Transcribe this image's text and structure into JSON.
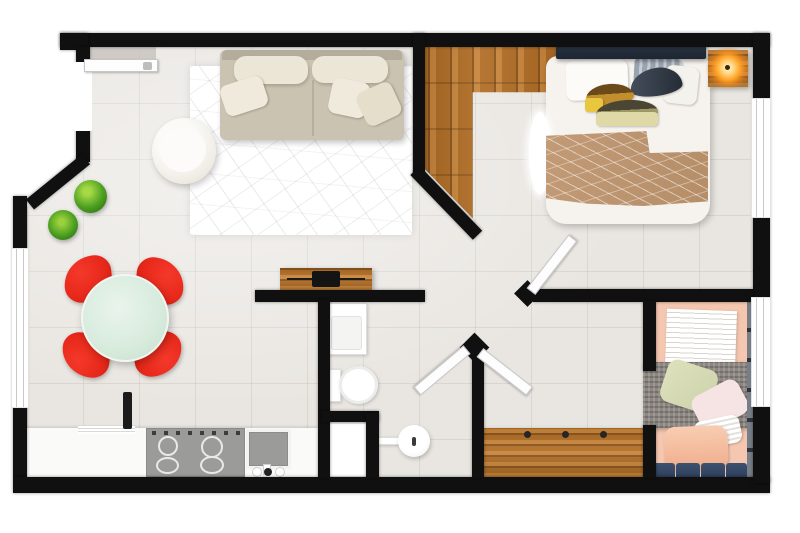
{
  "image": {
    "type": "3d-floor-plan-top-down-render",
    "description": "Top-down 3D render of a one-bedroom-plus-kids-room apartment floor plan with open living/dining/kitchen, master bedroom, second bedroom, bathroom and hallway",
    "width_px": 800,
    "height_px": 533
  },
  "palette": {
    "wall": "#101010",
    "floor_tile": "#e9e6e1",
    "wood": "#b06c24",
    "wood_light": "#c8853a",
    "wood_dark": "#8a541b",
    "rug": "#ffffff",
    "sofa": "#cbc3b1",
    "sofa_cushion": "#ebe6d6",
    "chair_red": "#e6281a",
    "table_mint": "#d7ebdd",
    "plant_green": "#4c9f21",
    "counter": "#fafaf8",
    "appliance_gray": "#9b9b99",
    "fixture_white": "#ffffff",
    "headboard_navy": "#1d2632",
    "blanket_tan": "#b58e68",
    "pillow_mustard": "#c18f2e",
    "pillow_khaki": "#a09a66",
    "pillow_gray": "#9aa4b0",
    "bed2_salmon": "#f5c7b0",
    "pillow_sage": "#ccd2aa",
    "pillow_blush": "#f6e3e4",
    "cushion_navy": "#2c3c58",
    "lamp_glow": "#ffa428",
    "window_frame": "#c9c9c9"
  },
  "rooms": [
    {
      "id": "living-dining-kitchen",
      "label": "open-plan living, dining and kitchen",
      "furniture": [
        "beige sofa with back cushions and three pillows",
        "white round lounge chair",
        "white geometric mesh rug",
        "two green plants",
        "round mint dining table",
        "four red designer chairs",
        "white kitchen counter",
        "four-burner cooktop",
        "square sink with faucet",
        "dish shelf",
        "dark utensil object"
      ]
    },
    {
      "id": "bedroom-1",
      "label": "master bedroom",
      "furniture": [
        "double bed with dark headboard",
        "white bedding with tan knit throw",
        "white fur runner",
        "six assorted pillows",
        "wooden nightstand",
        "glowing table lamp"
      ],
      "floor": "hardwood entry corner over tile",
      "windows": 1,
      "doors": 1
    },
    {
      "id": "bathroom",
      "label": "bathroom",
      "furniture": [
        "rectangular vanity sink",
        "toilet",
        "white shower-washer closet",
        "round pedestal basin with wall arm"
      ],
      "doors": 1
    },
    {
      "id": "hallway",
      "label": "hallway",
      "furniture": [
        "wooden tv sideboard with tv and soundbar on half wall",
        "long wooden bench with three knobs"
      ],
      "doors": 3
    },
    {
      "id": "bedroom-2",
      "label": "second bedroom",
      "furniture": [
        "single bed with salmon bedding",
        "white striped duvet",
        "gray knit throw",
        "sage pillow",
        "blush pillow",
        "white knit pillow",
        "salmon cushion",
        "four navy storage cushions",
        "tall narrow shelf unit"
      ],
      "windows": 1,
      "doors": 1
    }
  ],
  "openings": {
    "entry_doors": 1,
    "interior_door_leaves": 3,
    "windows": 3
  }
}
